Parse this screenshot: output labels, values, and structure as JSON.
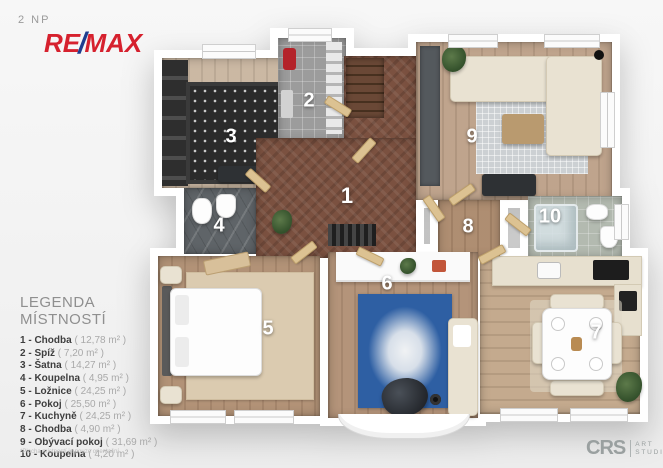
{
  "header": {
    "floor_label": "2 NP"
  },
  "brand": {
    "re": "RE",
    "slash": "/",
    "max": "MAX"
  },
  "legend": {
    "title": "LEGENDA MÍSTNOSTÍ",
    "items": [
      {
        "label": "1 - Chodba",
        "area": "( 12,78 m² )"
      },
      {
        "label": "2 - Spíž",
        "area": "( 7,20 m² )"
      },
      {
        "label": "3 - Šatna",
        "area": "( 14,27 m² )"
      },
      {
        "label": "4 - Koupelna",
        "area": "( 4,95 m² )"
      },
      {
        "label": "5 - Ložnice",
        "area": "( 24,25 m² )"
      },
      {
        "label": "6 - Pokoj",
        "area": "( 25,50 m² )"
      },
      {
        "label": "7 - Kuchyně",
        "area": "( 24,25 m² )"
      },
      {
        "label": "8 - Chodba",
        "area": "( 4,90 m² )"
      },
      {
        "label": "9 - Obývací pokoj",
        "area": "( 31,69 m² )"
      },
      {
        "label": "10 - Koupelna",
        "area": "( 4,20 m² )"
      }
    ],
    "footnote": "*Plocha místností je pouze orientační"
  },
  "plan": {
    "numbers": [
      "1",
      "2",
      "3",
      "4",
      "5",
      "6",
      "7",
      "8",
      "9",
      "10"
    ]
  },
  "studio": {
    "initials": "CRS",
    "word1": "ART",
    "word2": "STUDIO"
  },
  "colors": {
    "remax_red": "#D6212E",
    "remax_blue": "#1E3D8F",
    "hall_wood": "#7B5140",
    "rug_blue": "#2E5FA3",
    "bath_tile": "#B3BAB0",
    "logo_gray": "#9AA0A0"
  }
}
